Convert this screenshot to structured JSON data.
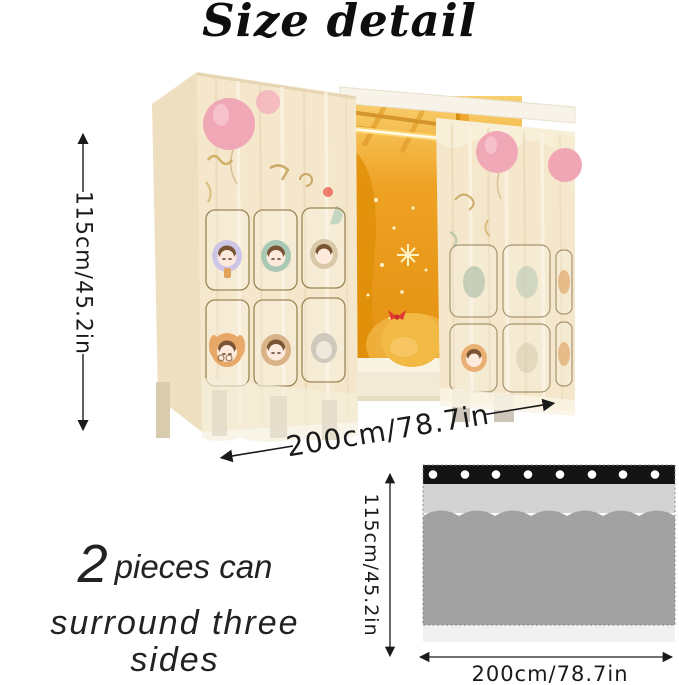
{
  "title": "Size detail",
  "photo": {
    "description": "bed with cartoon sheer curtains, lit interior",
    "height_label": "115cm/45.2in",
    "width_label": "200cm/78.7in"
  },
  "note": {
    "big": "2",
    "line1": "pieces can",
    "line2": "surround three sides"
  },
  "diagram": {
    "height_label": "115cm/45.2in",
    "width_label": "200cm/78.7in",
    "grommet_count": 8,
    "pleat_count": 5
  },
  "colors": {
    "text": "#1a1a1a",
    "curtain_cream": "#f4e7cb",
    "curtain_side": "#eedfc0",
    "balloon_pink": "#f1a8b6",
    "panel_black": "#141414",
    "panel_light_gray": "#d3d3d3",
    "panel_dark_gray": "#a2a2a2",
    "panel_hem": "#f1f1f1"
  }
}
